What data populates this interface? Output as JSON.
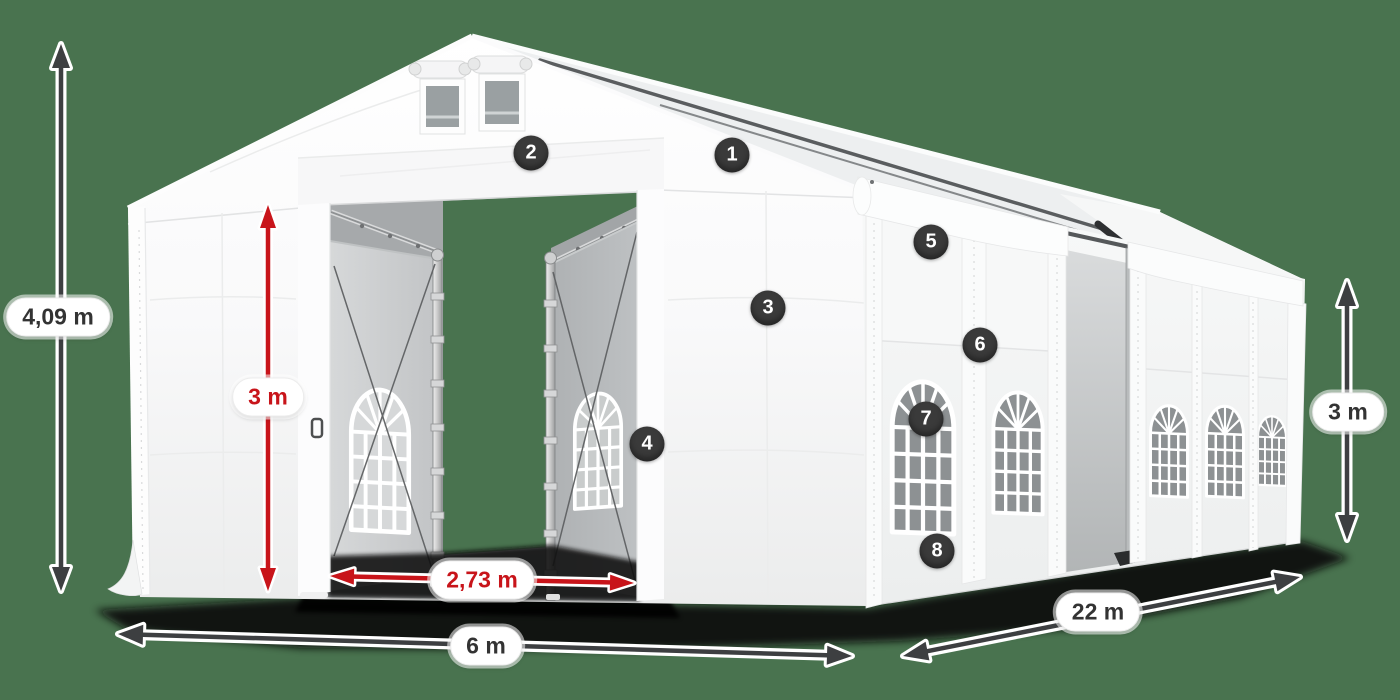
{
  "scene": {
    "description": "White party tent with open front doors, numbered feature callouts and dimension arrows",
    "background_color": "#49734f"
  },
  "labels": {
    "total_height": "4,09 m",
    "door_height": "3 m",
    "door_width": "2,73 m",
    "front_width": "6 m",
    "side_length": "22 m",
    "side_height": "3 m"
  },
  "callouts": {
    "c1": "1",
    "c2": "2",
    "c3": "3",
    "c4": "4",
    "c5": "5",
    "c6": "6",
    "c7": "7",
    "c8": "8"
  },
  "colors": {
    "background": "#49734f",
    "arrow-dark": "#3d3f41",
    "arrow-red": "#c8141a",
    "badge-bg": "#3a3a3a",
    "badge-text": "#ffffff",
    "pill-bg": "#ffffff",
    "pill-text": "#333333"
  }
}
